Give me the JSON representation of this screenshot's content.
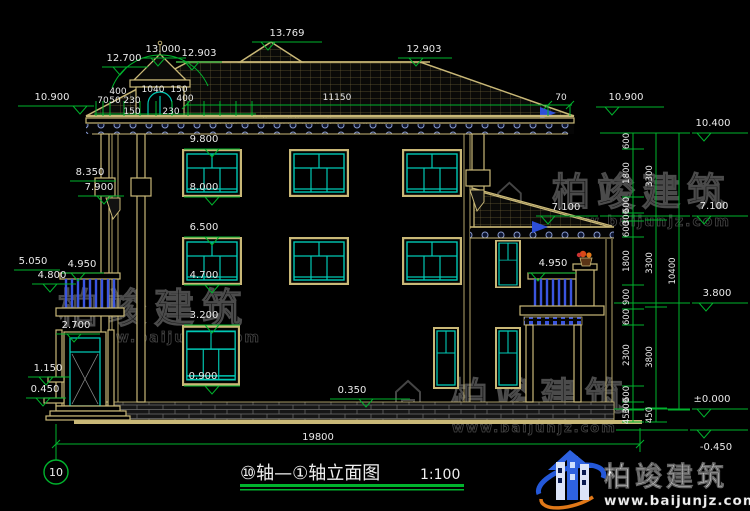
{
  "meta": {
    "background": "#000000",
    "cad_green": "#00b32d",
    "cad_cyan": "#00c8b4",
    "cad_tan": "#c9b877",
    "baluster_blue": "#3a55e0",
    "text_white": "#e9e9e9"
  },
  "titlebar": {
    "axis_bubble": "10",
    "title": "⑩轴—①轴立面图",
    "scale": "1:100"
  },
  "watermark": {
    "brand": "柏竣建筑",
    "url": "www.baijunjz.com"
  },
  "logo": {
    "brand": "柏竣建筑",
    "url": "www.baijunjz.com"
  },
  "levels": {
    "peak": "13.769",
    "cupola": "13.000",
    "ridge": "12.903",
    "corner": "12.700",
    "eave": "10.900",
    "top": "10.400",
    "w3top": "9.800",
    "capTop": "8.350",
    "w3sill": "8.000",
    "capBot": "7.900",
    "wing": "7.100",
    "w2top": "6.500",
    "balTop": "5.050",
    "balRail": "4.950",
    "balFloor": "4.800",
    "w2sill": "4.700",
    "porch": "3.800",
    "w1top": "3.200",
    "door": "2.700",
    "step1": "1.150",
    "w1sill": "0.900",
    "step0": "0.450",
    "plinth": "0.350",
    "zero": "±0.000",
    "ground": "-0.450"
  },
  "dims": {
    "overall": "19800",
    "roof": "11150",
    "d400": "400",
    "d1040": "1040",
    "d150": "150",
    "d230": "230",
    "d70": "70",
    "d50": "50",
    "c600": "600",
    "c1800": "1800",
    "c300": "300",
    "c900": "900",
    "c2300": "2300",
    "c450": "450",
    "t3300": "3300",
    "t3800": "3800",
    "t10400": "10400"
  }
}
